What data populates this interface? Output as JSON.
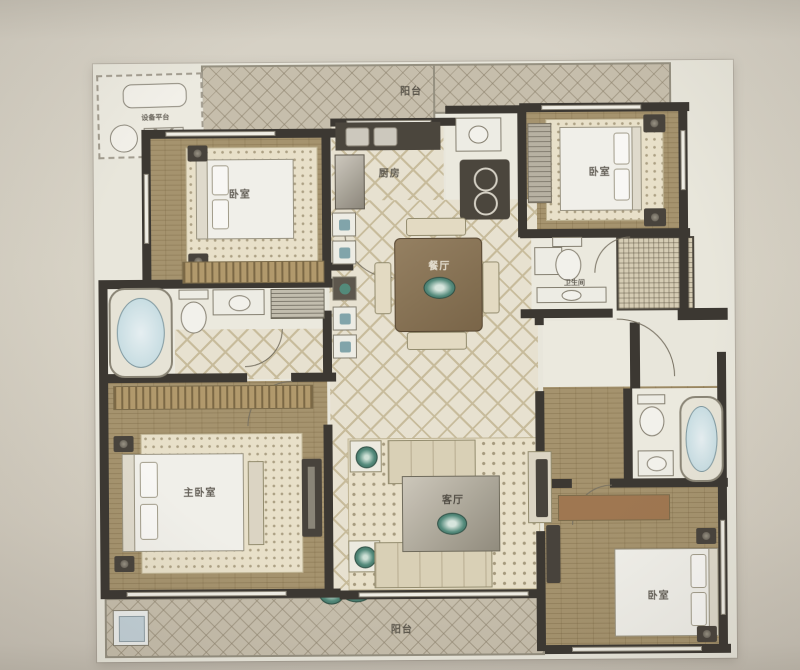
{
  "rooms": {
    "equipment_platform": "设备平台",
    "balcony_top": "阳台",
    "bedroom_top_left": "卧室",
    "kitchen": "厨房",
    "bedroom_top_right": "卧室",
    "dining_room": "餐厅",
    "bathroom": "卫生间",
    "master_bedroom": "主卧室",
    "living_room": "客厅",
    "bedroom_bottom_right": "卧室",
    "balcony_bottom": "阳台"
  },
  "colors": {
    "photo_background": "#d6d1c5",
    "plan_paper": "#ece9dd",
    "wall": "#3a362f",
    "wood_floor": "#a8946a",
    "tile_floor": "#ebe4d1",
    "balcony_hatch": "#c9c0ac",
    "tub_water": "#bcd9e0",
    "plant_teal": "#4e8b7a",
    "label_text": "#4b463c"
  }
}
